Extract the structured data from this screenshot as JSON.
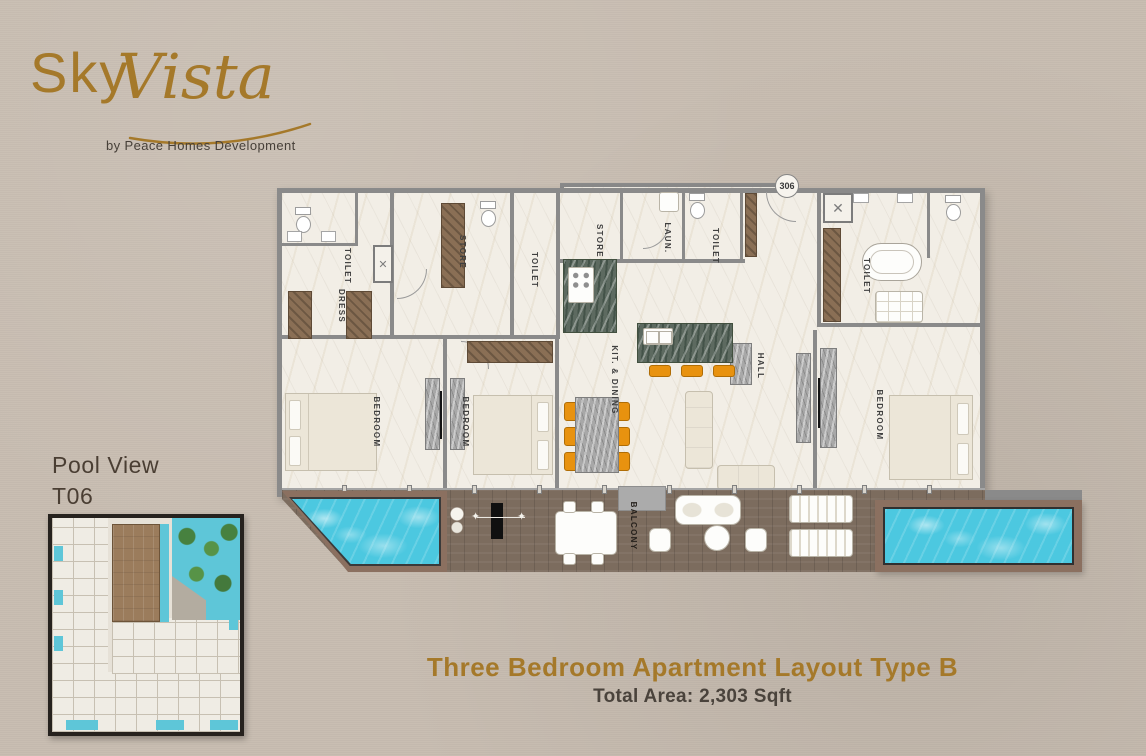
{
  "brand": {
    "logo_sky": "Sky",
    "logo_vista": "Vista",
    "tagline": "by Peace Homes Development"
  },
  "unit": {
    "badge": "306",
    "view_line1": "Pool View",
    "view_line2": "T06"
  },
  "footer": {
    "title": "Three Bedroom Apartment Layout Type B",
    "area": "Total Area: 2,303 Sqft"
  },
  "rooms": [
    {
      "id": "toilet-1",
      "label": "TOILET"
    },
    {
      "id": "dress",
      "label": "DRESS"
    },
    {
      "id": "store-1",
      "label": "STORE"
    },
    {
      "id": "toilet-2",
      "label": "TOILET"
    },
    {
      "id": "store-2",
      "label": "STORE"
    },
    {
      "id": "laundry",
      "label": "LAUN."
    },
    {
      "id": "toilet-3",
      "label": "TOILET"
    },
    {
      "id": "toilet-master",
      "label": "TOILET"
    },
    {
      "id": "bedroom-1",
      "label": "BEDROOM"
    },
    {
      "id": "bedroom-2",
      "label": "BEDROOM"
    },
    {
      "id": "kitchen-dining",
      "label": "KIT. & DINING"
    },
    {
      "id": "hall",
      "label": "HALL"
    },
    {
      "id": "bedroom-3",
      "label": "BEDROOM"
    },
    {
      "id": "balcony",
      "label": "BALCONY"
    }
  ],
  "colors": {
    "background": "#c8bdb1",
    "gold": "#a5792a",
    "text_dark": "#4a433c",
    "wall_gray": "#8a8a8a",
    "pool_cyan": "#4cc8e0",
    "deck_wood": "#7c6c5e",
    "chair_orange": "#e8920f"
  }
}
